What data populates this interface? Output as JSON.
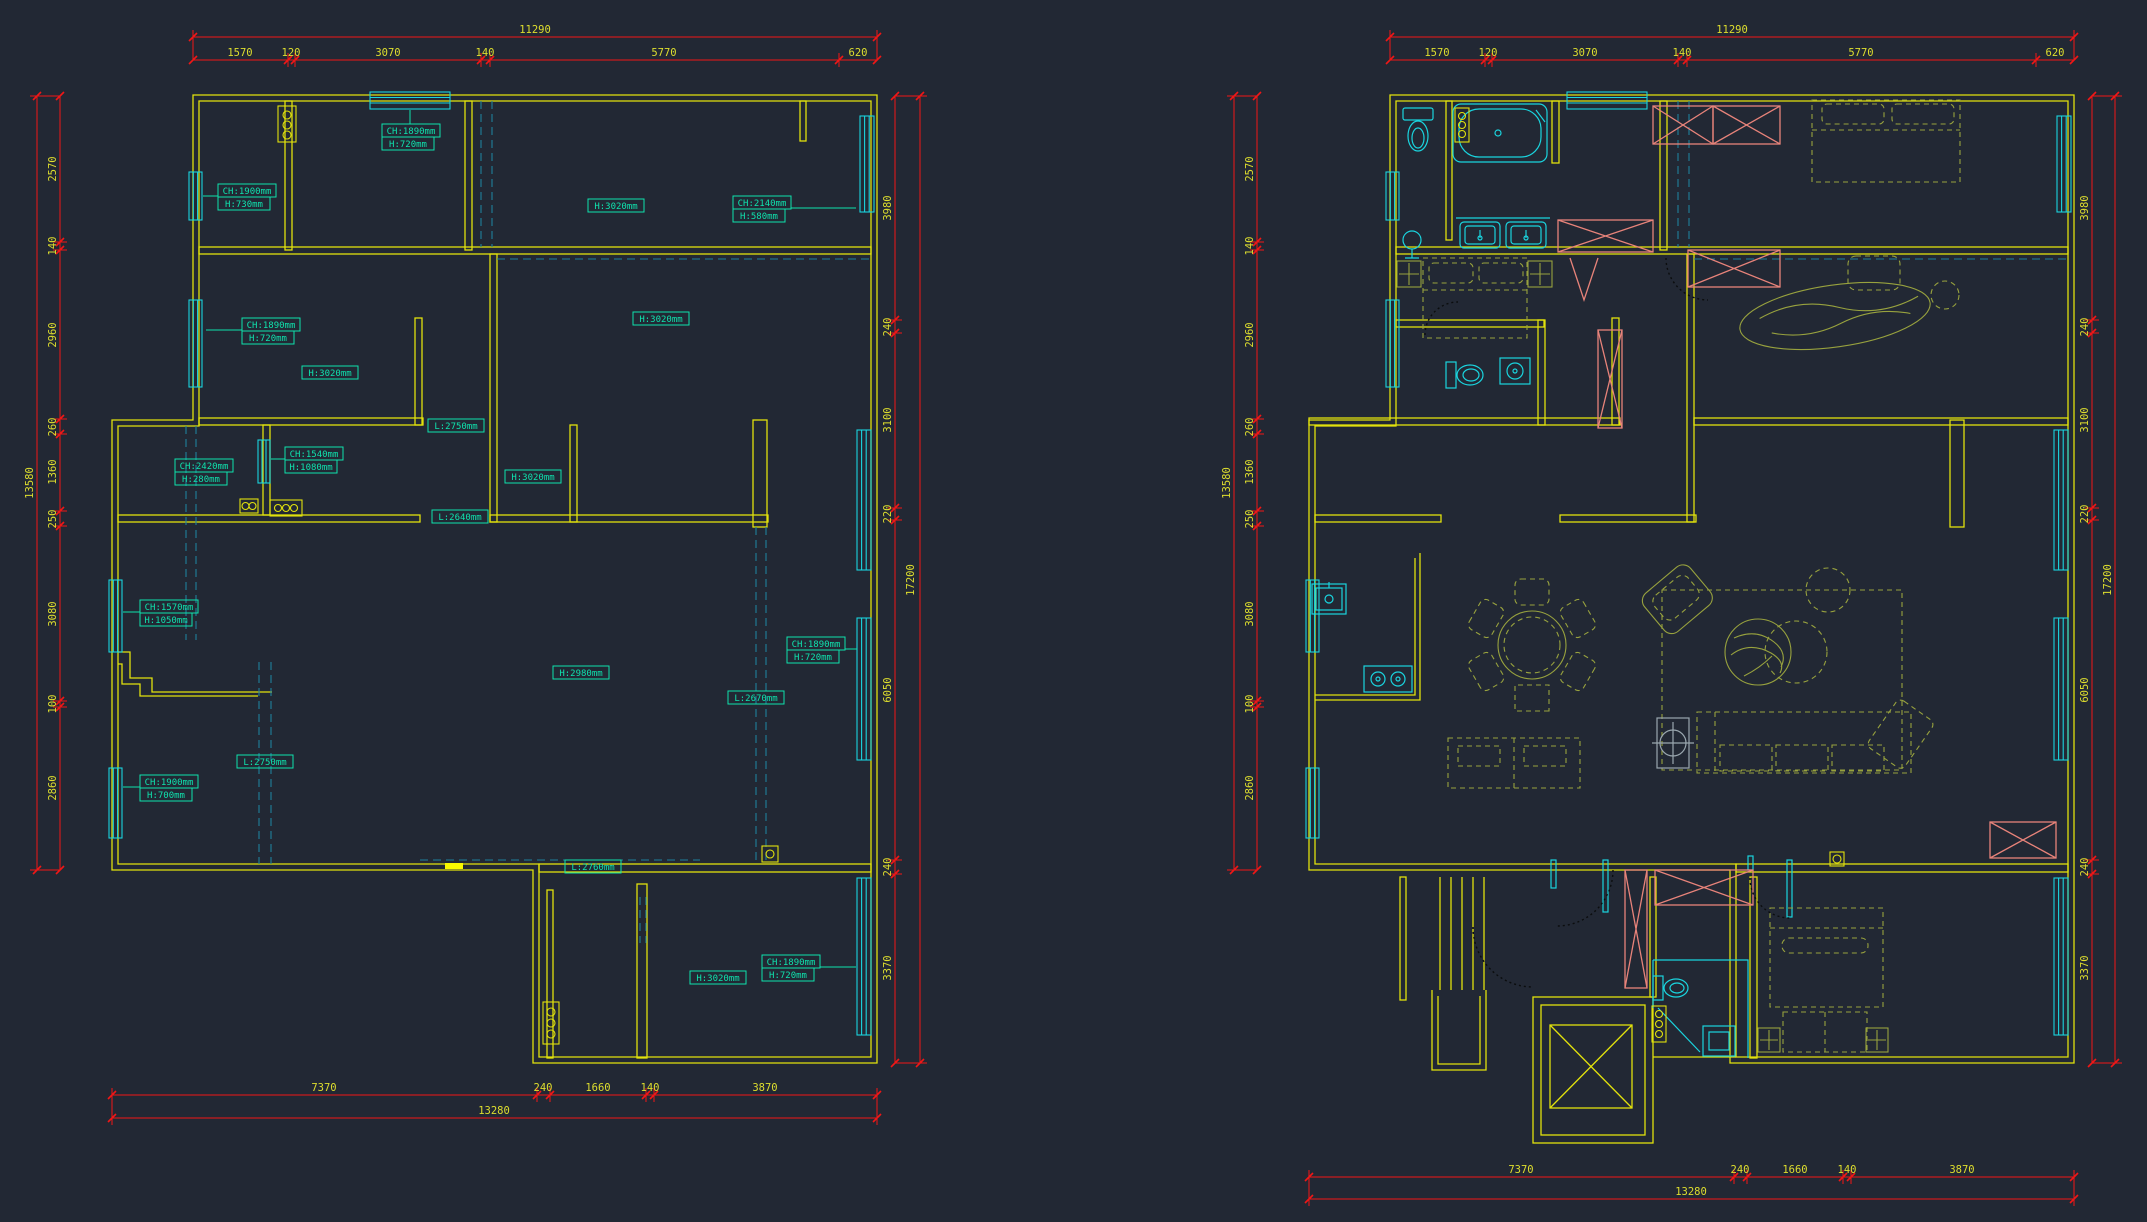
{
  "colors": {
    "background": "#222834",
    "wall": "#e2e20c",
    "dimension_line": "#f21616",
    "dimension_text": "#dede2e",
    "window": "#1ad4de",
    "label": "#0fe2ad",
    "hidden_dash": "#1e7f9c",
    "furniture": "#98a23e",
    "wardrobe": "#e8837a",
    "column_marker": "#9aa7af",
    "door_swing": "#0b0d0e",
    "highlight": "#f8f800"
  },
  "left_plan": {
    "dims_top": {
      "total": "11290",
      "segments": [
        "1570",
        "120",
        "3070",
        "140",
        "5770",
        "620"
      ]
    },
    "dims_left": {
      "total": "13580",
      "segments": [
        "2570",
        "140",
        "2960",
        "260",
        "1360",
        "250",
        "3080",
        "100",
        "2860"
      ]
    },
    "dims_right": {
      "total": "17200",
      "segments": [
        "3980",
        "240",
        "3100",
        "220",
        "6050",
        "240",
        "3370"
      ]
    },
    "dims_bottom": {
      "total": "13280",
      "segments": [
        "7370",
        "240",
        "1660",
        "140",
        "3870"
      ]
    },
    "labels": [
      {
        "l1": "CH:1890mm",
        "l2": "H:720mm"
      },
      {
        "l1": "CH:1900mm",
        "l2": "H:730mm"
      },
      {
        "l1": "H:3020mm"
      },
      {
        "l1": "CH:2140mm",
        "l2": "H:580mm"
      },
      {
        "l1": "CH:1890mm",
        "l2": "H:720mm"
      },
      {
        "l1": "H:3020mm"
      },
      {
        "l1": "L:2750mm"
      },
      {
        "l1": "H:3020mm"
      },
      {
        "l1": "CH:2420mm",
        "l2": "H:280mm"
      },
      {
        "l1": "CH:1540mm",
        "l2": "H:1080mm"
      },
      {
        "l1": "H:3020mm"
      },
      {
        "l1": "L:2640mm"
      },
      {
        "l1": "CH:1570mm",
        "l2": "H:1050mm"
      },
      {
        "l1": "H:2980mm"
      },
      {
        "l1": "L:2670mm"
      },
      {
        "l1": "CH:1890mm",
        "l2": "H:720mm"
      },
      {
        "l1": "L:2750mm"
      },
      {
        "l1": "CH:1900mm",
        "l2": "H:700mm"
      },
      {
        "l1": "L:2760mm"
      },
      {
        "l1": "H:3020mm"
      },
      {
        "l1": "CH:1890mm",
        "l2": "H:720mm"
      }
    ]
  },
  "right_plan": {
    "dims_top": {
      "total": "11290",
      "segments": [
        "1570",
        "120",
        "3070",
        "140",
        "5770",
        "620"
      ]
    },
    "dims_left": {
      "total": "13580",
      "segments": [
        "2570",
        "140",
        "2960",
        "260",
        "1360",
        "250",
        "3080",
        "100",
        "2860"
      ]
    },
    "dims_right": {
      "total": "17200",
      "segments": [
        "3980",
        "240",
        "3100",
        "220",
        "6050",
        "240",
        "3370"
      ]
    },
    "dims_bottom": {
      "total": "13280",
      "segments": [
        "7370",
        "240",
        "1660",
        "140",
        "3870"
      ]
    }
  }
}
